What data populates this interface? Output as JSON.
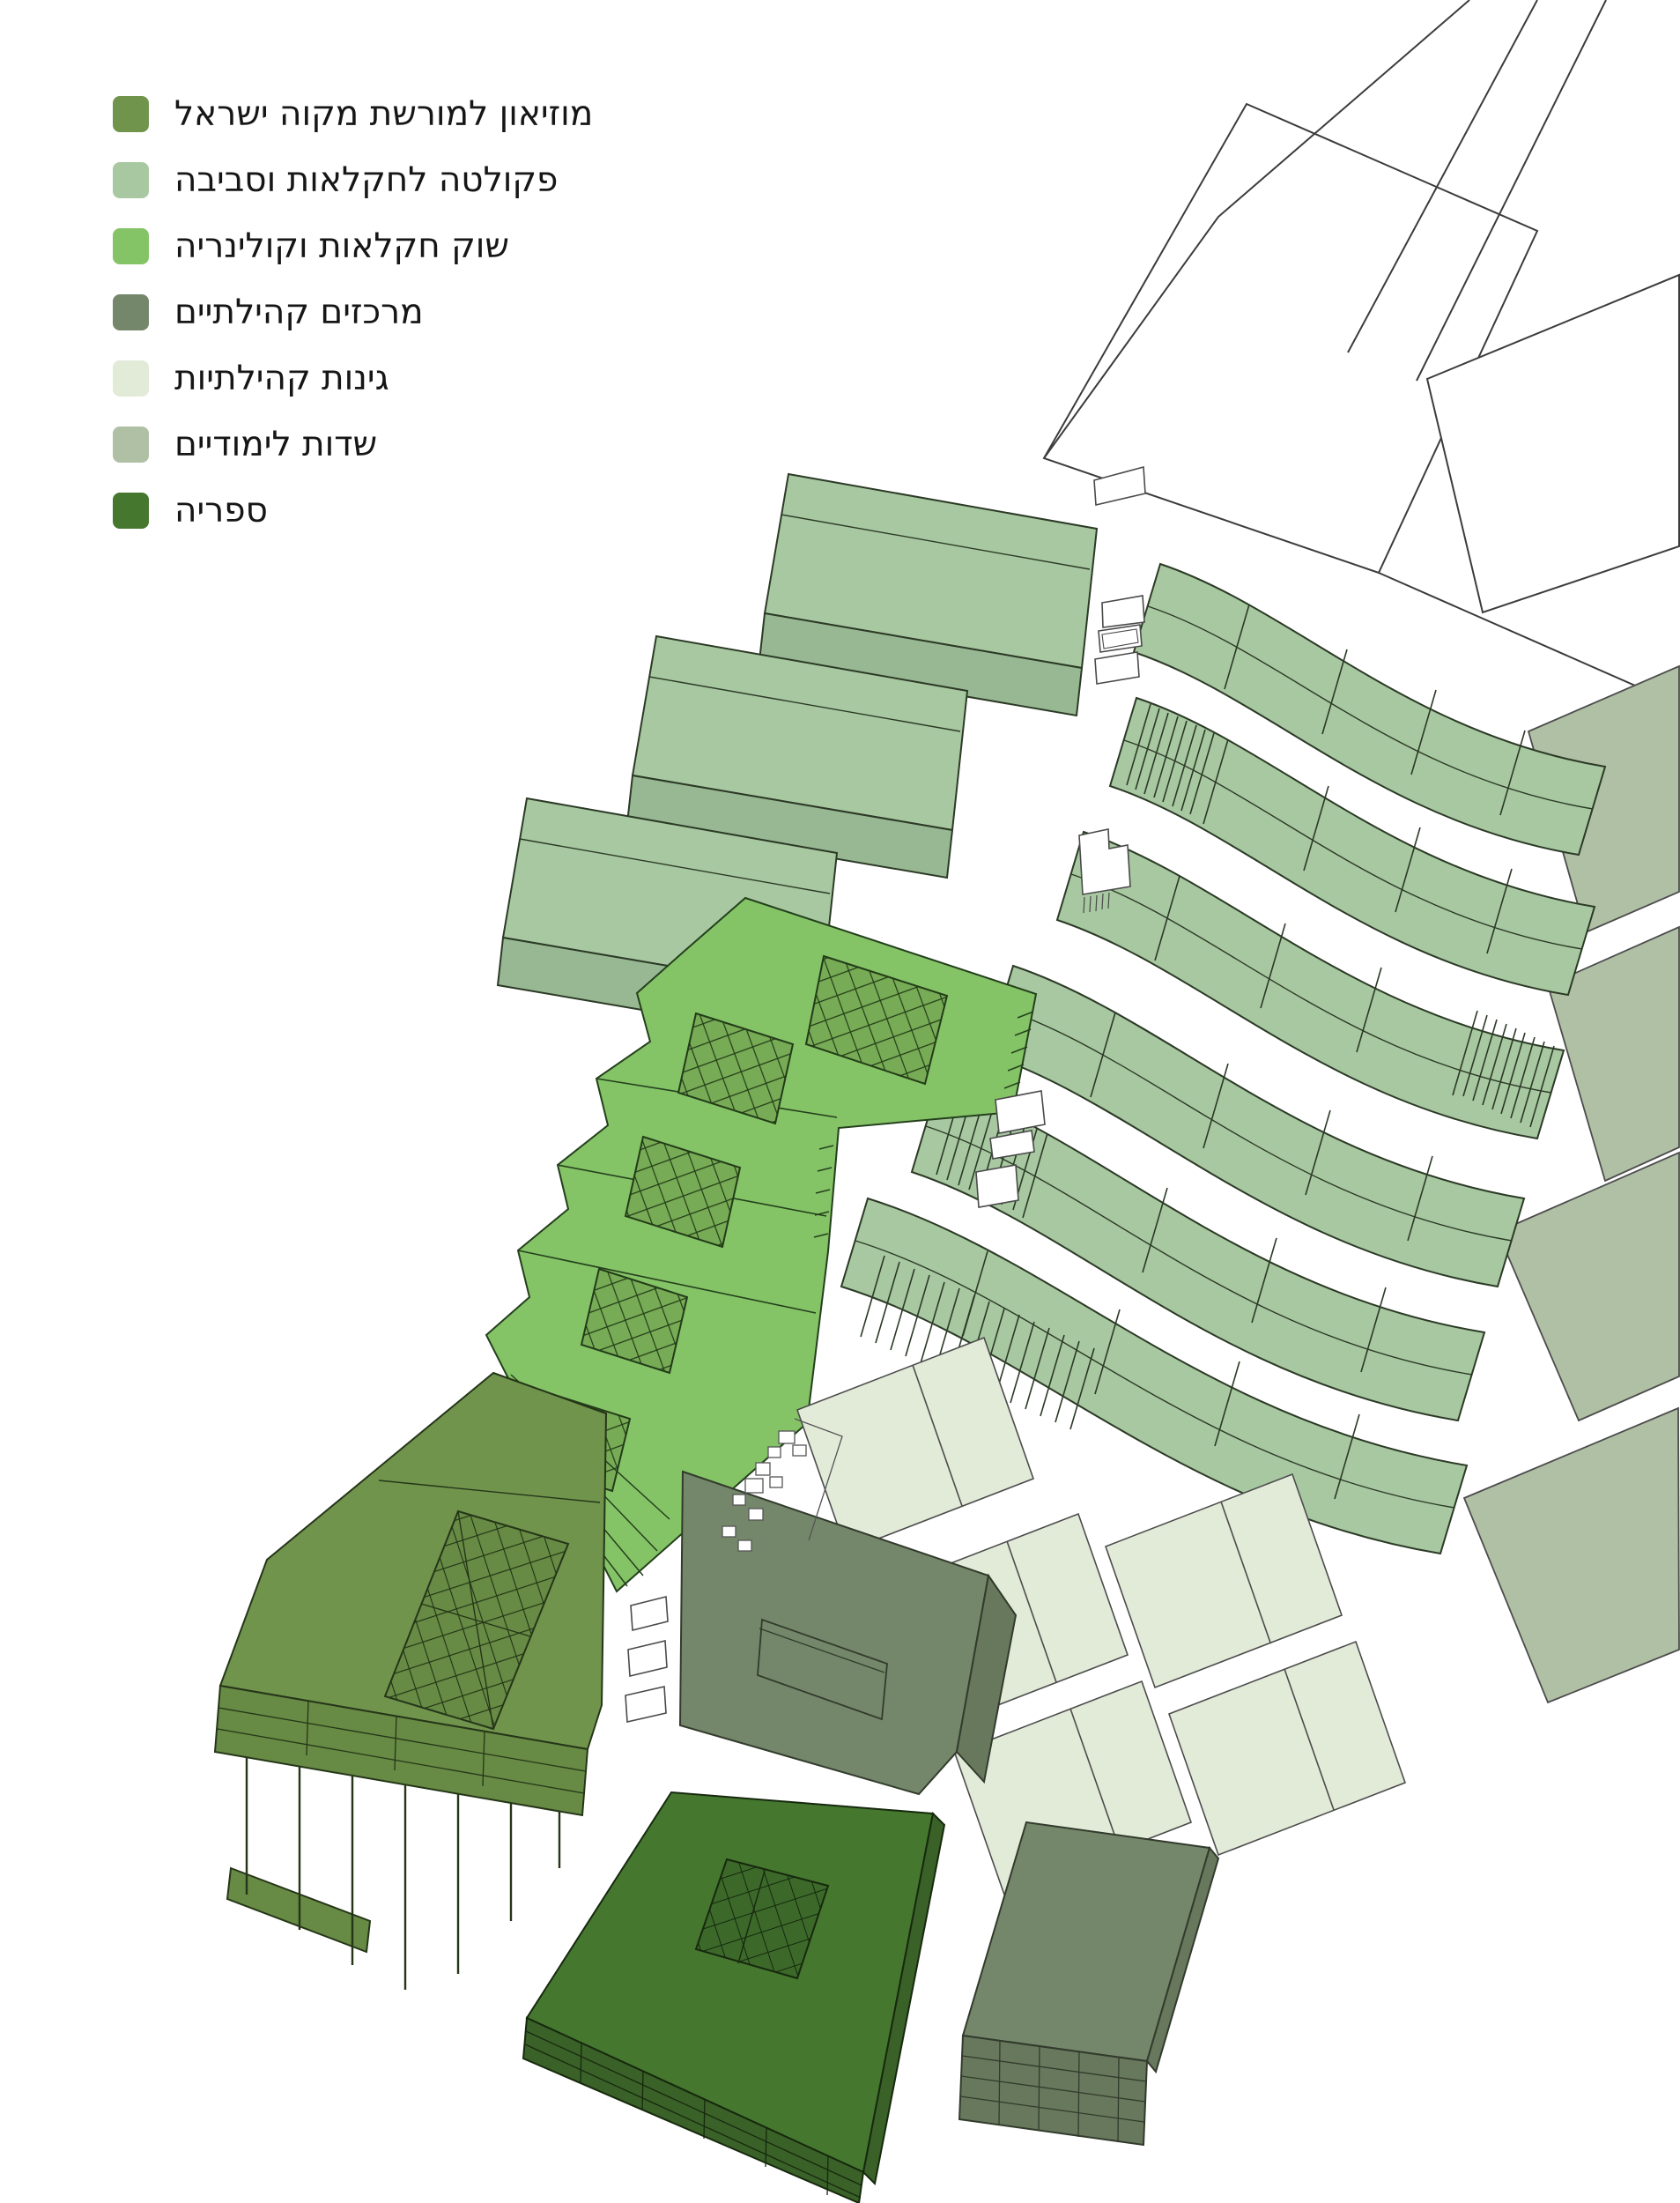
{
  "legend": {
    "items": [
      {
        "id": "museum",
        "label": "מוזיאון למורשת מקוה ישראל",
        "color": "#71944d"
      },
      {
        "id": "faculty",
        "label": "פקולטה לחקלאות וסביבה",
        "color": "#a7c8a1"
      },
      {
        "id": "market",
        "label": "שוק חקלאות וקולינריה",
        "color": "#85c367"
      },
      {
        "id": "community_centers",
        "label": "מרכזים קהילתיים",
        "color": "#74876a"
      },
      {
        "id": "community_gardens",
        "label": "גינות קהילתיות",
        "color": "#e2ead8"
      },
      {
        "id": "study_fields",
        "label": "שדות לימודיים",
        "color": "#b0c0a5"
      },
      {
        "id": "library",
        "label": "ספריה",
        "color": "#45772f"
      }
    ]
  },
  "drawing": {
    "context_ink": "#3c3c3c",
    "green_ink": "#2c3a26"
  }
}
